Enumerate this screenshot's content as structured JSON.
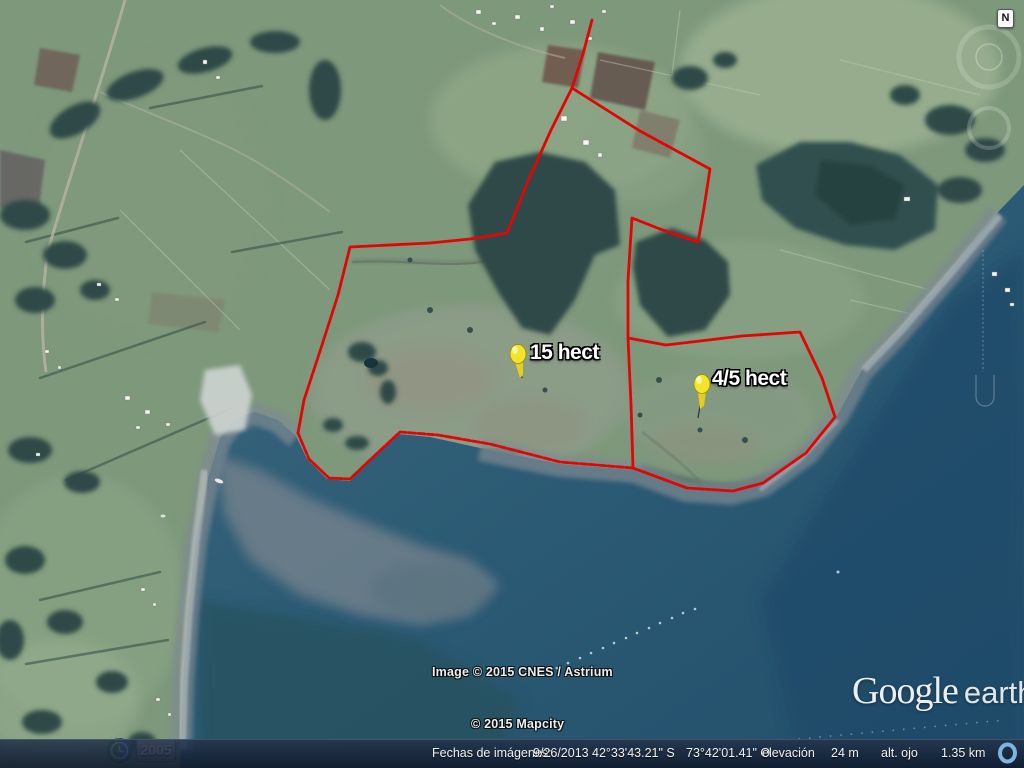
{
  "map": {
    "parcels": [
      {
        "label": "15 hect"
      },
      {
        "label": "4/5 hect"
      }
    ],
    "colors": {
      "boundary_red": "#e10505",
      "pin_yellow": "#f2e32b",
      "ocean": "#2b5a74",
      "land_green": "#7e987c"
    }
  },
  "compass": {
    "north_label": "N"
  },
  "attribution": {
    "imagery": "Image © 2015 CNES / Astrium",
    "map_data": "© 2015 Mapcity"
  },
  "logo": {
    "brand": "Google",
    "product": "earth"
  },
  "timeline": {
    "year": "2005"
  },
  "statusbar": {
    "imagery_date_label": "Fechas de imágenes:",
    "imagery_date": "9/26/2013",
    "latitude": "42°33'43.21\" S",
    "longitude": "73°42'01.41\" O",
    "elevation_label": "elevación",
    "elevation_value": "24 m",
    "eye_alt_label": "alt. ojo",
    "eye_alt_value": "1.35 km"
  }
}
